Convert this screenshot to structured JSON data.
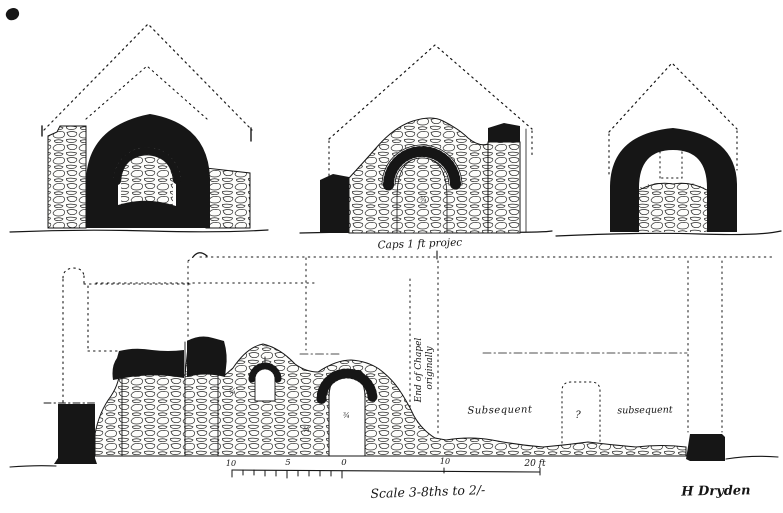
{
  "colors": {
    "paper": "#ffffff",
    "ink": "#161616"
  },
  "captions": {
    "middle_elevation": "Caps 1 ft projec",
    "vertical_note_line1": "End of Chapel",
    "vertical_note_line2": "originally",
    "subsequent_left": "Subsequent",
    "subsequent_right": "subsequent",
    "query": "?",
    "mark_a": "¾",
    "mark_b": "¾",
    "mark_c": "¾",
    "mark_d": "¾"
  },
  "scale_bar": {
    "tick_10_left": "10",
    "tick_5": "5",
    "tick_0": "0",
    "tick_10_right": "10",
    "tick_20": "20 ft",
    "caption": "Scale 3-8ths to 2/-"
  },
  "signature": "H Dryden"
}
